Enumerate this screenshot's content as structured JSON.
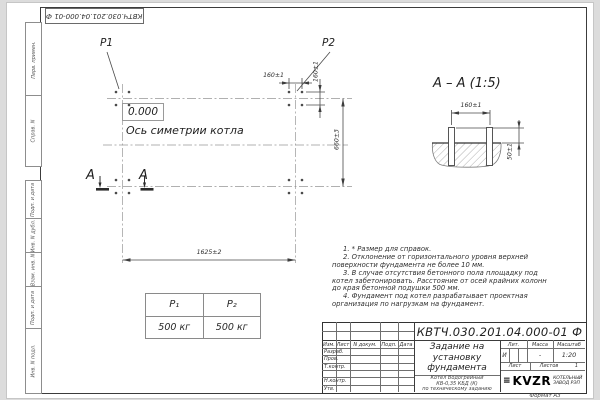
{
  "frame": {
    "format_label": "Формат А3",
    "margin_top": [
      "Перв. примен.",
      "Справ. N"
    ],
    "margin_bottom": [
      "Подп. и дата",
      "Инв. N дубл.",
      "Взам. инв. N",
      "Подп. и дата",
      "Инв. N подл."
    ]
  },
  "plan": {
    "load_label_1": "P1",
    "load_label_2": "P2",
    "elevation_mark": "0.000",
    "symmetry_axis_label": "Ось симетрии котла",
    "section_letter": "A",
    "dims": {
      "overall_width": "1625±2",
      "row_spacing": "660±3",
      "bolt_spacing_h": "160±1",
      "bolt_spacing_v": "160±1"
    }
  },
  "section_view": {
    "title": "А – А (1:5)",
    "dims": {
      "bolt_spacing": "160±1",
      "protrusion": "50±1"
    }
  },
  "notes": [
    "1. * Размер для справок.",
    "2. Отклонение от горизонтального уровня верхней поверхности фундамента не более 10 мм.",
    "3. В случае отсутствия бетонного пола площадку под котел забетонировать. Расстояние от осей крайних колонн до края бетонной подушки 500 мм.",
    "4. Фундамент под котел разрабатывает проектная организация по нагрузкам на фундамент."
  ],
  "load_table": {
    "headers": [
      "P₁",
      "P₂"
    ],
    "values": [
      "500 кг",
      "500 кг"
    ]
  },
  "title_block": {
    "designation": "КВТЧ.030.201.04.000-01  Ф",
    "title_lines": [
      "Задание на",
      "установку",
      "фундамента"
    ],
    "product_lines": [
      "Котел Водогрейный",
      "КВ-0,35 КБД (К)",
      "по техническому заданию"
    ],
    "columns": [
      "Изм.",
      "Лист",
      "N докум.",
      "Подп.",
      "Дата"
    ],
    "rows": [
      "Разраб.",
      "Пров.",
      "Т.контр.",
      "",
      "Н.контр.",
      "Утв."
    ],
    "lit_label": "Лит.",
    "lit_value": "И",
    "mass_label": "Масса",
    "mass_value": "-",
    "scale_label": "Масштаб",
    "scale_value": "1:20",
    "sheet_label": "Лист",
    "sheets_label": "Листов",
    "sheets_value": "1",
    "logo_glyph": "≡",
    "logo_text": "KVZR",
    "logo_caption": [
      "КОТЕЛЬНЫЙ",
      "ЗАВОД РЭП"
    ]
  }
}
